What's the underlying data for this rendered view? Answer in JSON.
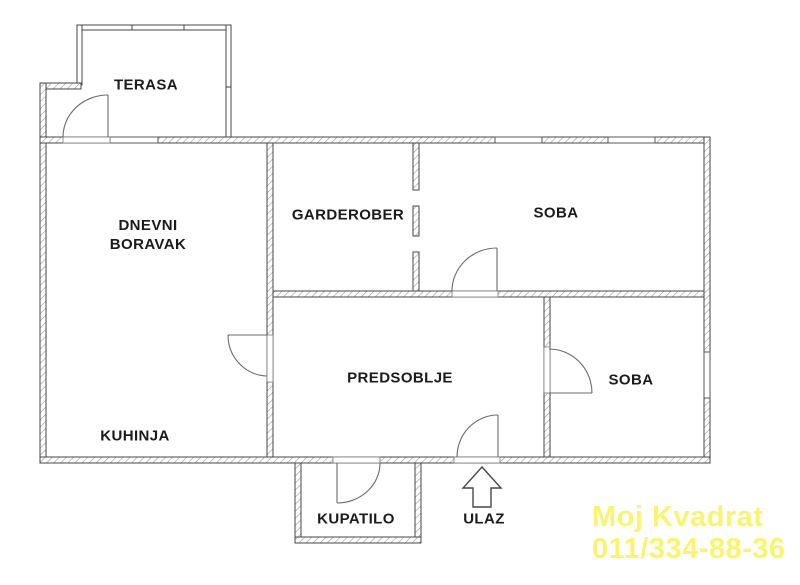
{
  "plan": {
    "type": "apartment-floor-plan",
    "rooms": {
      "terasa": "TERASA",
      "dnevni_boravak": "DNEVNI BORAVAK",
      "garderober": "GARDEROBER",
      "soba_top": "SOBA",
      "predsoblje": "PREDSOBLJE",
      "soba_bottom": "SOBA",
      "kuhinja": "KUHINJA",
      "kupatilo": "KUPATILO",
      "ulaz": "ULAZ"
    }
  },
  "watermark": {
    "line1": "Moj Kvadrat",
    "line2": "011/334-88-36",
    "color": "#FBF46E"
  },
  "colors": {
    "background": "#ffffff",
    "wall_outline": "#474747",
    "hatch_line": "#9b9b9b",
    "door_line": "#6b6b6b",
    "label_text": "#1b1b1b"
  }
}
